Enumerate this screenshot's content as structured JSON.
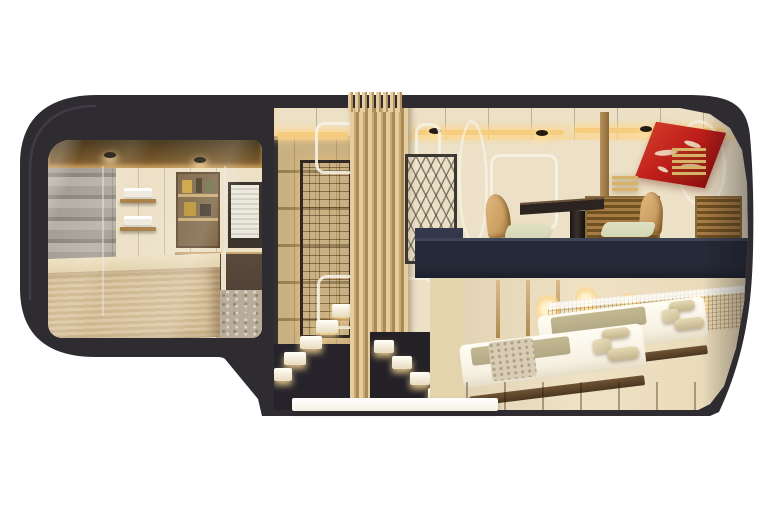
{
  "scene": {
    "type": "cutaway-render",
    "description": "Side cutaway rendering of a luxury sleeper train carriage: rounded dark shell, glass lounge with wood counter at the front, lit staircase and slatted screens in the entry, duplex suite at the rear with upper dining deck (table, chairs, red artwork) and lower bedroom deck with two low beds.",
    "regions": [
      "lounge-bar",
      "entry-staircase",
      "slat-screen-corridor",
      "upper-dining-deck",
      "lower-bedroom-deck"
    ]
  },
  "palette": {
    "background": "#ffffff",
    "body": "#2e2b31",
    "body-edge": "#514b56",
    "ceiling-wood": "#6e5228",
    "glow-gold": "#f7cd7c",
    "wall-cream": "#ece0c6",
    "corridor-wood": "#c9b183",
    "brick-glow": "#edbd6d",
    "slat-light": "#e5cd9f",
    "slat-dark": "#a98a58",
    "stair-white": "#fbf4e4",
    "navy-floor": "#262a38",
    "chair-tan": "#cc9f63",
    "cushion-green": "#d3d5b3",
    "blind-wood": "#a87c45",
    "art-red": "#bf1f1a",
    "art-cream": "#efe0c4",
    "headboard-wood": "#d8bc8e",
    "bed-white": "#f6f0e2",
    "bed-olive": "#b2a884",
    "floor-wood": "#9c7b50",
    "stone-grey": "#a59e95",
    "counter-wood": "#dcc7a4",
    "ghost-frame": "#f6f2e6"
  }
}
